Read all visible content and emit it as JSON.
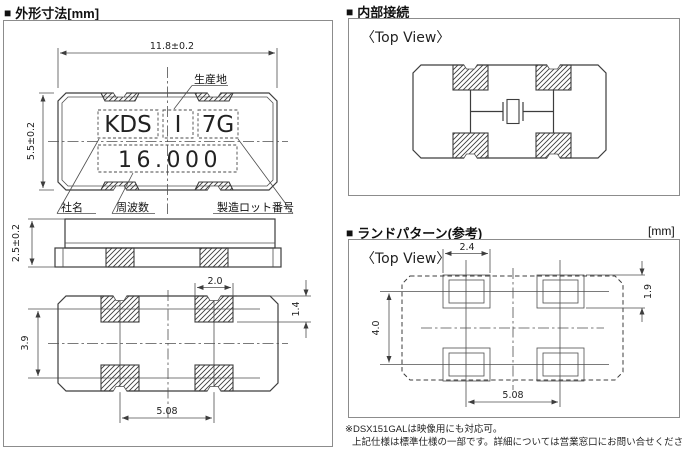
{
  "icons": {
    "bullet": "■"
  },
  "colors": {
    "background": "#ffffff",
    "line": "#3d3d3d",
    "box_border": "#8c8c8c",
    "text": "#111111"
  },
  "outline_section": {
    "title": "外形寸法[mm]",
    "dims": {
      "body_width": "11.8±0.2",
      "body_height": "5.5±0.2",
      "body_thickness": "2.5±0.2",
      "pad_width": "2.0",
      "pad_height": "1.4",
      "pad_row_pitch": "3.9",
      "pad_col_pitch": "5.08"
    },
    "marking": {
      "company_code": "KDS",
      "origin_mark": "I",
      "lot_code": "7G",
      "frequency": "16.000"
    },
    "callouts": {
      "origin": "生産地",
      "company": "社名",
      "frequency": "周波数",
      "lot": "製造ロット番号"
    }
  },
  "internal_section": {
    "title": "内部接続",
    "view_label": "〈Top View〉"
  },
  "land_section": {
    "title": "ランドパターン(参考)",
    "unit_label": "[mm]",
    "view_label": "〈Top View〉",
    "dims": {
      "land_width": "2.4",
      "land_height": "1.9",
      "row_pitch": "4.0",
      "col_pitch": "5.08"
    }
  },
  "footnote": {
    "line1": "※DSX151GALは映像用にも対応可。",
    "line2": "上記仕様は標準仕様の一部です。詳細については営業窓口にお問い合せください。"
  }
}
